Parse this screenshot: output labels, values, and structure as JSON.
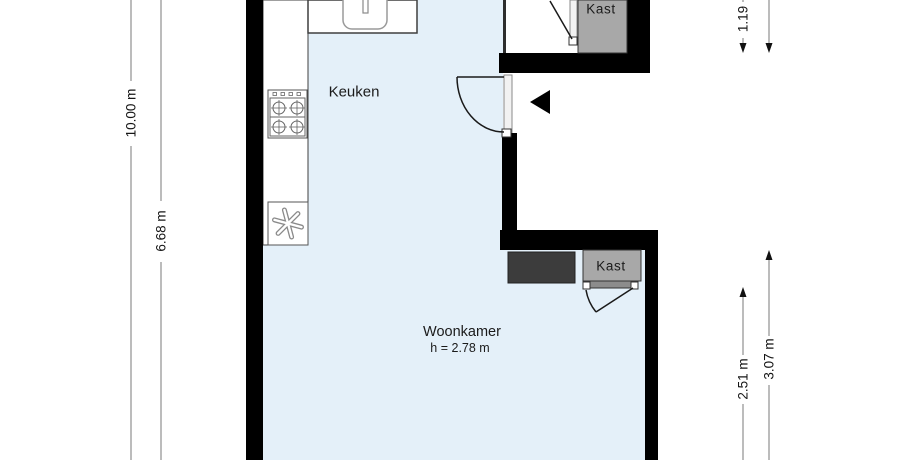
{
  "plan": {
    "rooms": [
      {
        "label": "Keuken"
      },
      {
        "label": "Woonkamer",
        "ceiling_height": "h = 2.78 m"
      }
    ],
    "closets": {
      "top": {
        "label": "Kast"
      },
      "bottom": {
        "label": "Kast"
      }
    },
    "dimensions": {
      "left_outer": "10.00 m",
      "left_inner": "6.68 m",
      "right_top": "1.19",
      "right_inner": "2.51 m",
      "right_outer": "3.07 m"
    },
    "colors": {
      "floor": "#e4f0f9",
      "wall": "#000000",
      "closet_light": "#a8a8a8",
      "closet_dark": "#3c3c3c"
    },
    "icons": {
      "sink": "sink-icon",
      "stove": "stove-icon",
      "ventilation": "ventilation-fan-icon",
      "entrance": "entrance-arrow-icon"
    }
  }
}
